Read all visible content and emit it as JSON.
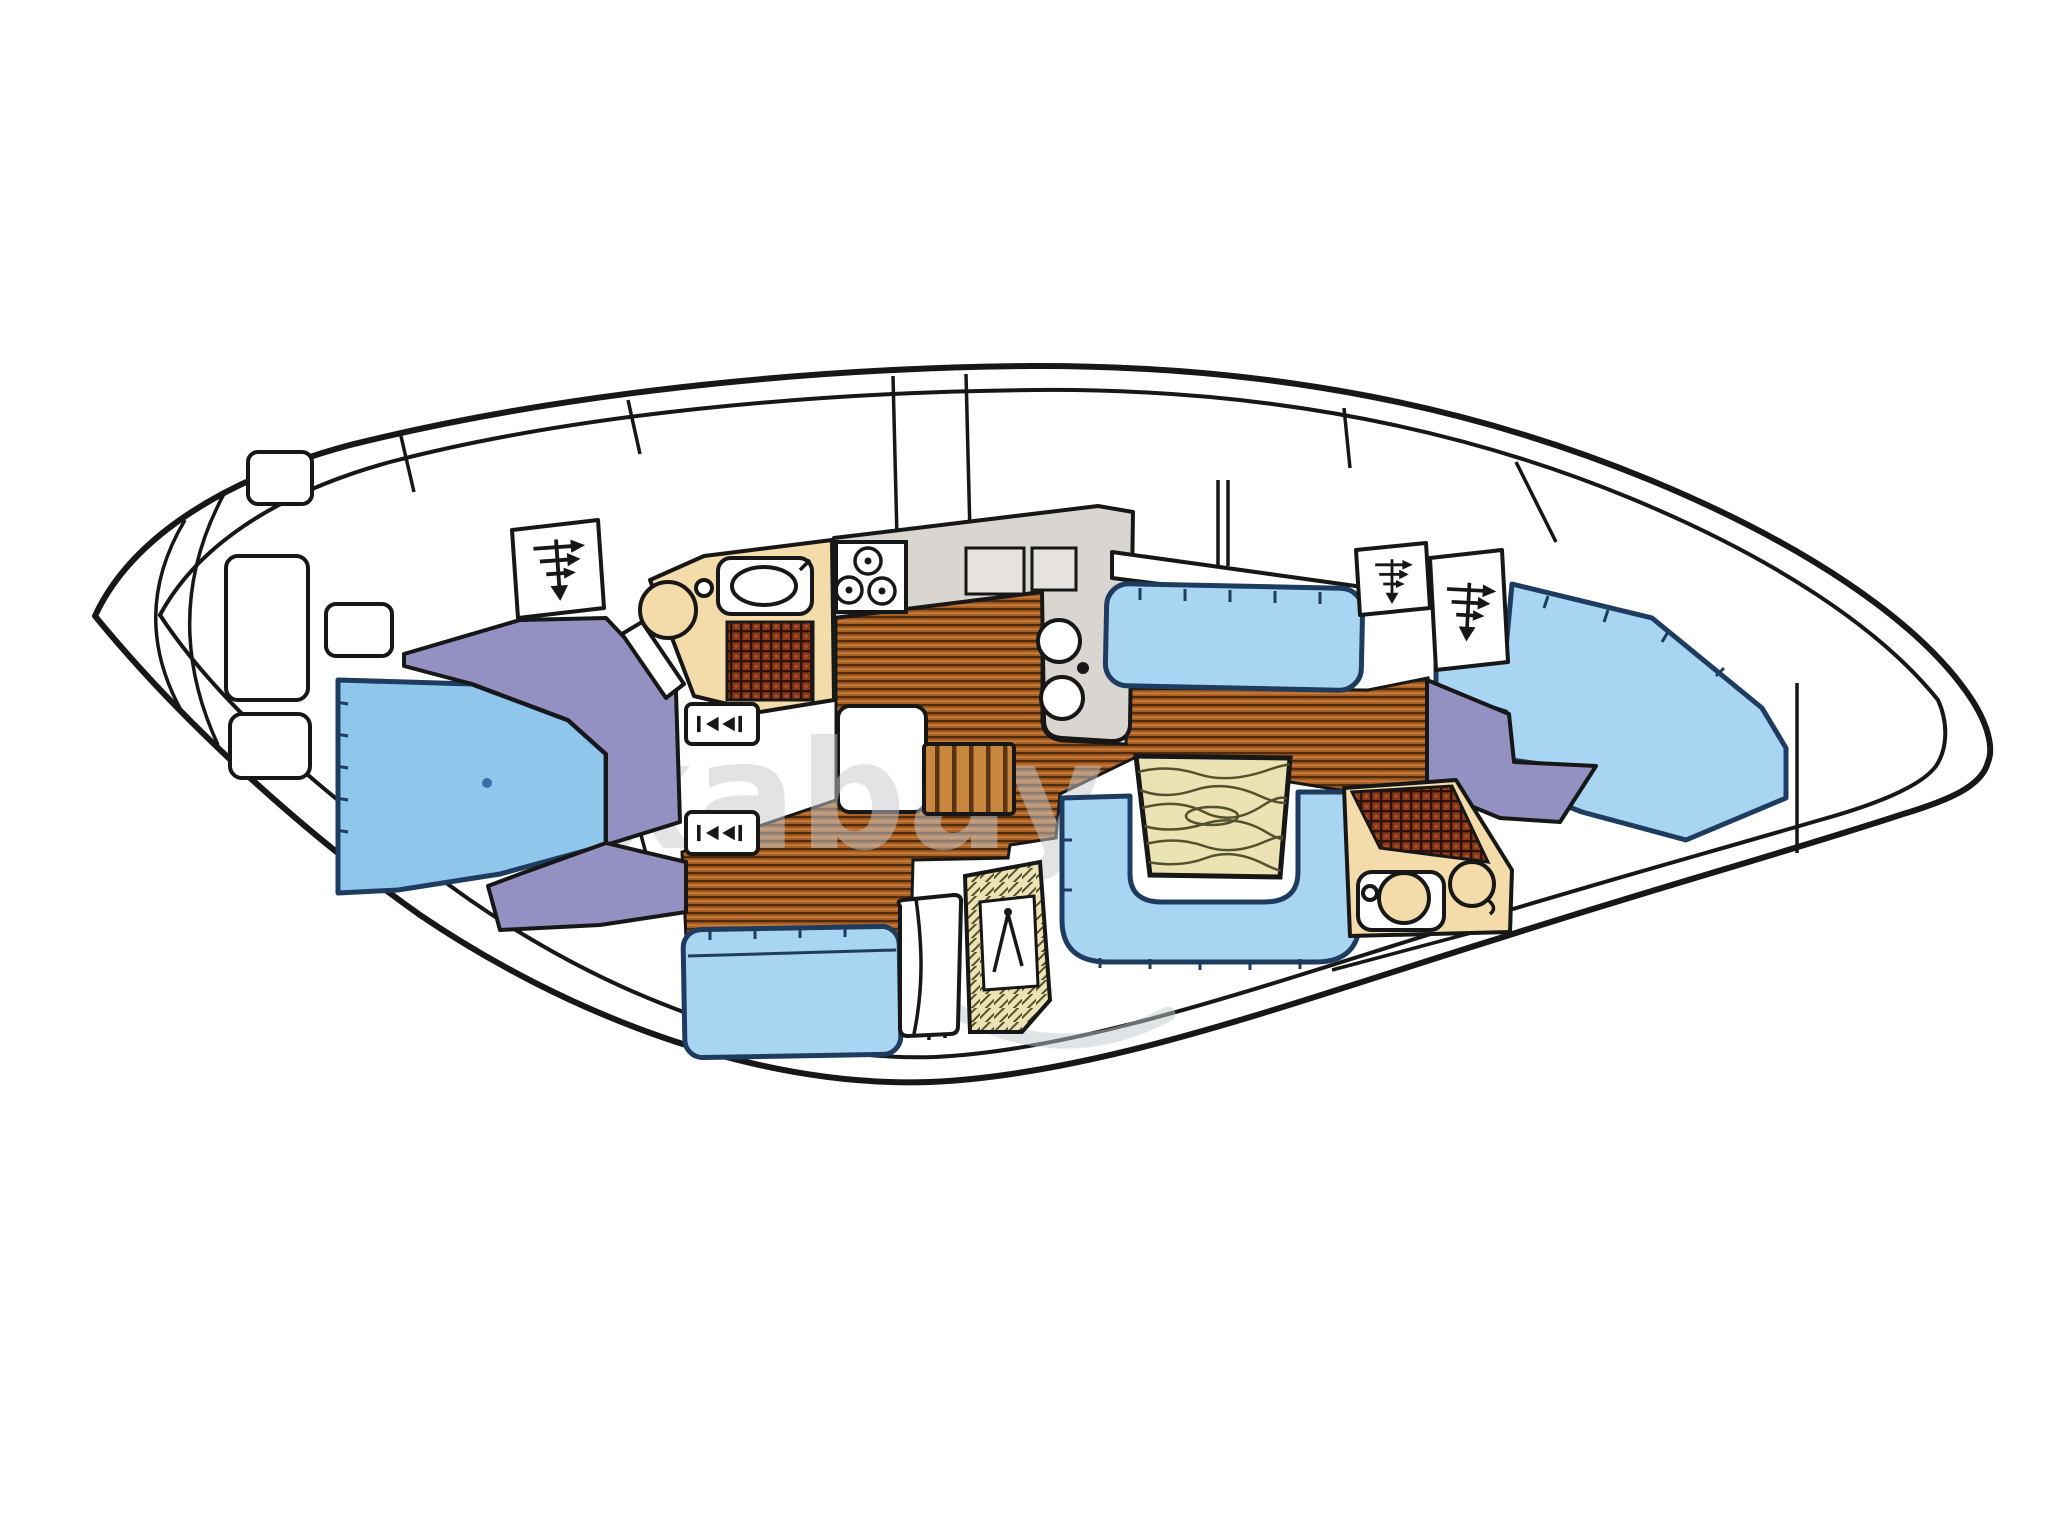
{
  "figure": {
    "type": "boat-interior-floor-plan",
    "description": "Top-view interior layout plan of a sailing yacht, bow at left, stern at right"
  },
  "watermark": {
    "text": "pixabay"
  },
  "colors": {
    "ink": "#171717",
    "outline_navy": "#1e3c60",
    "cushion_blue": "#a8d5f2",
    "berth_blue": "#8fc6ec",
    "cabinet_purple": "#9391c2",
    "head_cream": "#f3dcaa",
    "counter_gray": "#d9d6d1",
    "locker_gray": "#e6e3de",
    "wood_base": "#a85e22",
    "wood_stripe": "#4f2c10",
    "wood_light": "#c9803a",
    "steps_base": "#c8873f",
    "steps_stripe": "#5a3414",
    "plaid_base": "#8a3a1a",
    "plaid_line": "#2e1006",
    "table_wood": "#ece3b4",
    "grain_line": "#55512e",
    "watermark_gray": "#c4c9cd"
  }
}
